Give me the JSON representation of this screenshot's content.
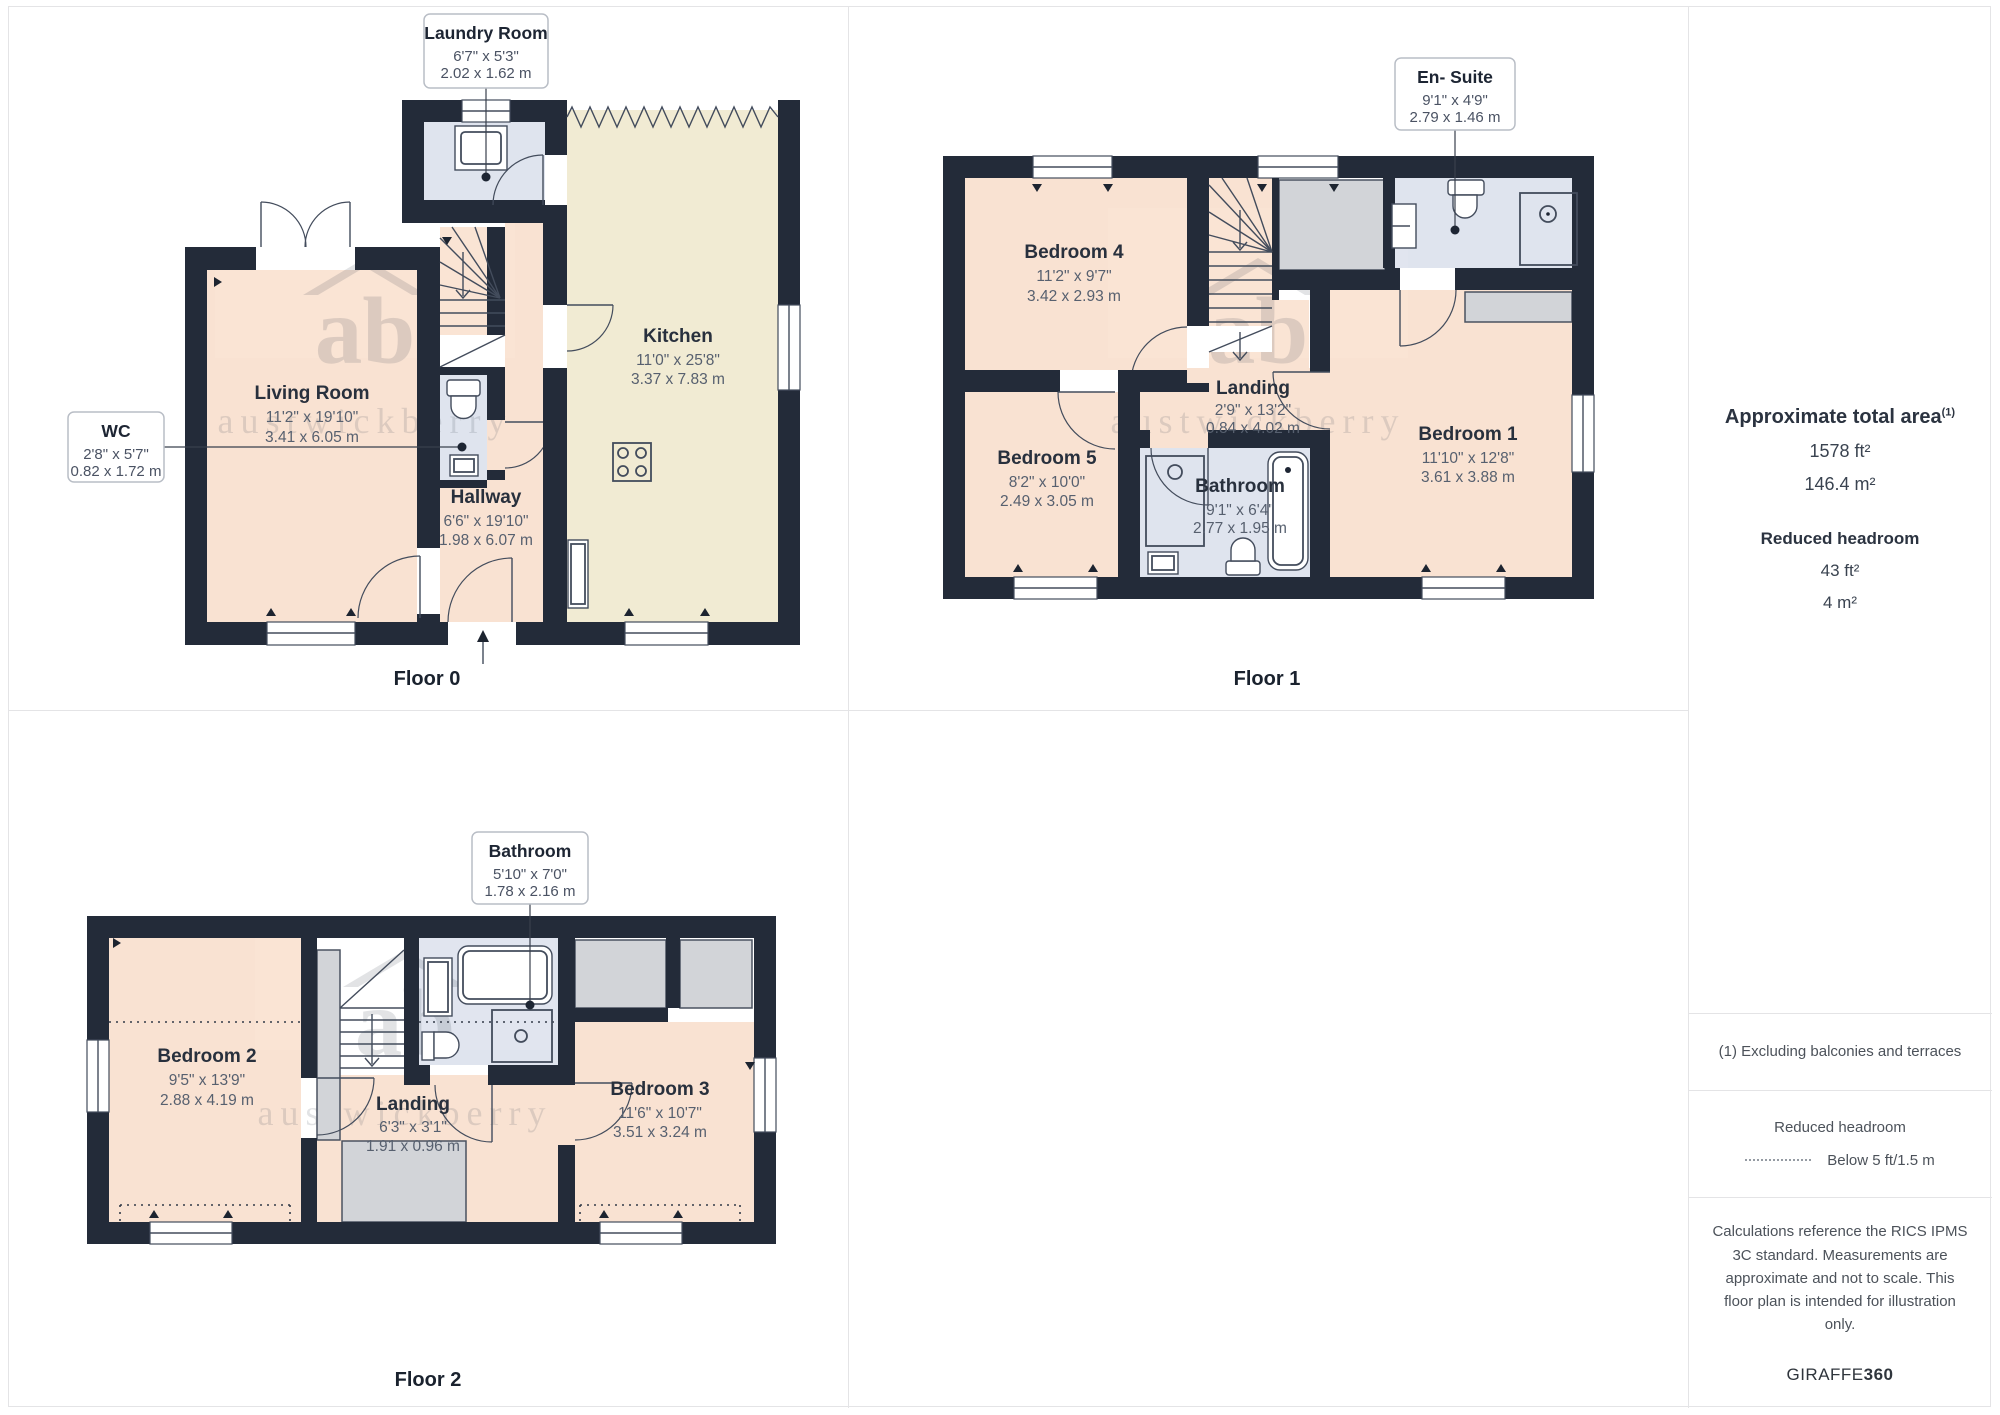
{
  "watermark": {
    "initials": "ab",
    "name": "austwickberry"
  },
  "floors": {
    "f0": {
      "label": "Floor 0",
      "living": {
        "name": "Living Room",
        "ft": "11'2\" x 19'10\"",
        "m": "3.41 x 6.05 m"
      },
      "hallway": {
        "name": "Hallway",
        "ft": "6'6\" x 19'10\"",
        "m": "1.98 x 6.07 m"
      },
      "kitchen": {
        "name": "Kitchen",
        "ft": "11'0\" x 25'8\"",
        "m": "3.37 x 7.83 m"
      },
      "laundry": {
        "name": "Laundry Room",
        "ft": "6'7\" x 5'3\"",
        "m": "2.02 x 1.62 m"
      },
      "wc": {
        "name": "WC",
        "ft": "2'8\" x 5'7\"",
        "m": "0.82 x 1.72 m"
      }
    },
    "f1": {
      "label": "Floor 1",
      "bedroom4": {
        "name": "Bedroom 4",
        "ft": "11'2\" x 9'7\"",
        "m": "3.42 x 2.93 m"
      },
      "bedroom5": {
        "name": "Bedroom 5",
        "ft": "8'2\" x 10'0\"",
        "m": "2.49 x 3.05 m"
      },
      "landing": {
        "name": "Landing",
        "ft": "2'9\" x 13'2\"",
        "m": "0.84 x 4.02 m"
      },
      "bathroom": {
        "name": "Bathroom",
        "ft": "9'1\" x 6'4\"",
        "m": "2.77 x 1.95 m"
      },
      "bedroom1": {
        "name": "Bedroom 1",
        "ft": "11'10\" x 12'8\"",
        "m": "3.61 x 3.88 m"
      },
      "ensuite": {
        "name": "En- Suite",
        "ft": "9'1\" x 4'9\"",
        "m": "2.79 x 1.46 m"
      }
    },
    "f2": {
      "label": "Floor 2",
      "bedroom2": {
        "name": "Bedroom 2",
        "ft": "9'5\" x 13'9\"",
        "m": "2.88 x 4.19 m"
      },
      "landing": {
        "name": "Landing",
        "ft": "6'3\" x 3'1\"",
        "m": "1.91 x 0.96 m"
      },
      "bedroom3": {
        "name": "Bedroom 3",
        "ft": "11'6\" x 10'7\"",
        "m": "3.51 x 3.24 m"
      },
      "bathroom": {
        "name": "Bathroom",
        "ft": "5'10\" x 7'0\"",
        "m": "1.78 x 2.16 m"
      }
    }
  },
  "sidebar": {
    "total": {
      "title": "Approximate total area",
      "sup": "(1)",
      "ft": "1578 ft²",
      "m": "146.4 m²"
    },
    "reduced": {
      "title": "Reduced headroom",
      "ft": "43 ft²",
      "m": "4 m²"
    },
    "footnote": "(1) Excluding balconies and terraces",
    "legend": {
      "title": "Reduced headroom",
      "item": "Below 5 ft/1.5 m"
    },
    "disclaimer": "Calculations reference the RICS IPMS 3C standard. Measurements are approximate and not to scale. This floor plan is intended for illustration only.",
    "brand": {
      "name": "GIRAFFE",
      "bold": "360"
    }
  },
  "colors": {
    "wall": "#232b39",
    "room_warm": "#f9e2d2",
    "room_kitchen": "#f1ebd3",
    "room_wet": "#dfe4ee",
    "storage": "#d2d4d8",
    "line": "#434c5c"
  }
}
